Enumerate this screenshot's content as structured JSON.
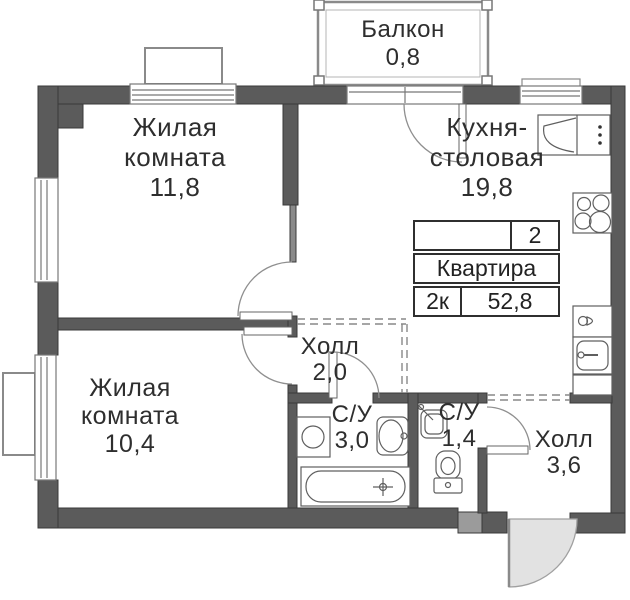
{
  "title_block": {
    "flat_number": "2",
    "flat_label": "Квартира",
    "rooms_code": "2к",
    "total_area": "52,8"
  },
  "rooms": {
    "living1": {
      "name_line1": "Жилая",
      "name_line2": "комната",
      "area": "11,8"
    },
    "living2": {
      "name_line1": "Жилая",
      "name_line2": "комната",
      "area": "10,4"
    },
    "kitchen": {
      "name_line1": "Кухня-",
      "name_line2": "столовая",
      "area": "19,8"
    },
    "hall1": {
      "name": "Холл",
      "area": "2,0"
    },
    "hall2": {
      "name": "Холл",
      "area": "3,6"
    },
    "bath1": {
      "name": "С/У",
      "area": "3,0"
    },
    "bath2": {
      "name": "С/У",
      "area": "1,4"
    },
    "balcony": {
      "name": "Балкон",
      "area": "0,8"
    }
  },
  "colors": {
    "wall": "#5b5b5b",
    "wall_outline": "#3a3a3a",
    "partition": "#8a8a8a",
    "fixture_line": "#5f5f5f",
    "door_arc": "#8f8f8f",
    "entry_door_fill": "#e2e2e2",
    "text": "#2e2e2e",
    "background": "#ffffff"
  }
}
